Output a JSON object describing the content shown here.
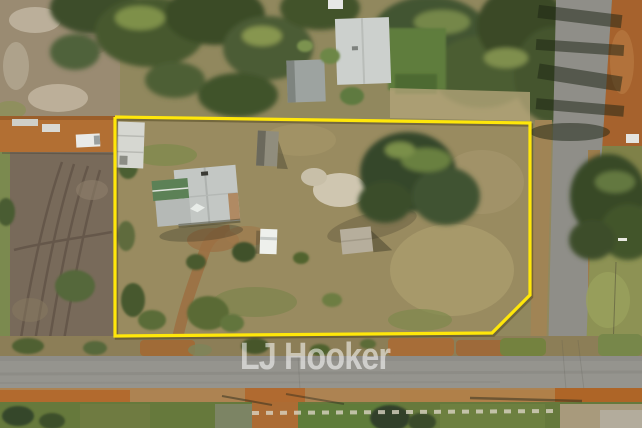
{
  "photo": {
    "watermark": "LJ Hooker"
  },
  "boundary": {
    "points": "115,117 530,123 530,295 492,333 115,336 115,117",
    "color": "#FFE70A"
  },
  "colors": {
    "watermark_text": "#FFFFFF",
    "asphalt_road": "#95948E",
    "red_dirt": "#B06F35",
    "paddock_grass": "#97895E",
    "tree_canopy": "#44552E",
    "house_roof": "#C3C7C4",
    "house_green_roof": "#5C8156"
  }
}
